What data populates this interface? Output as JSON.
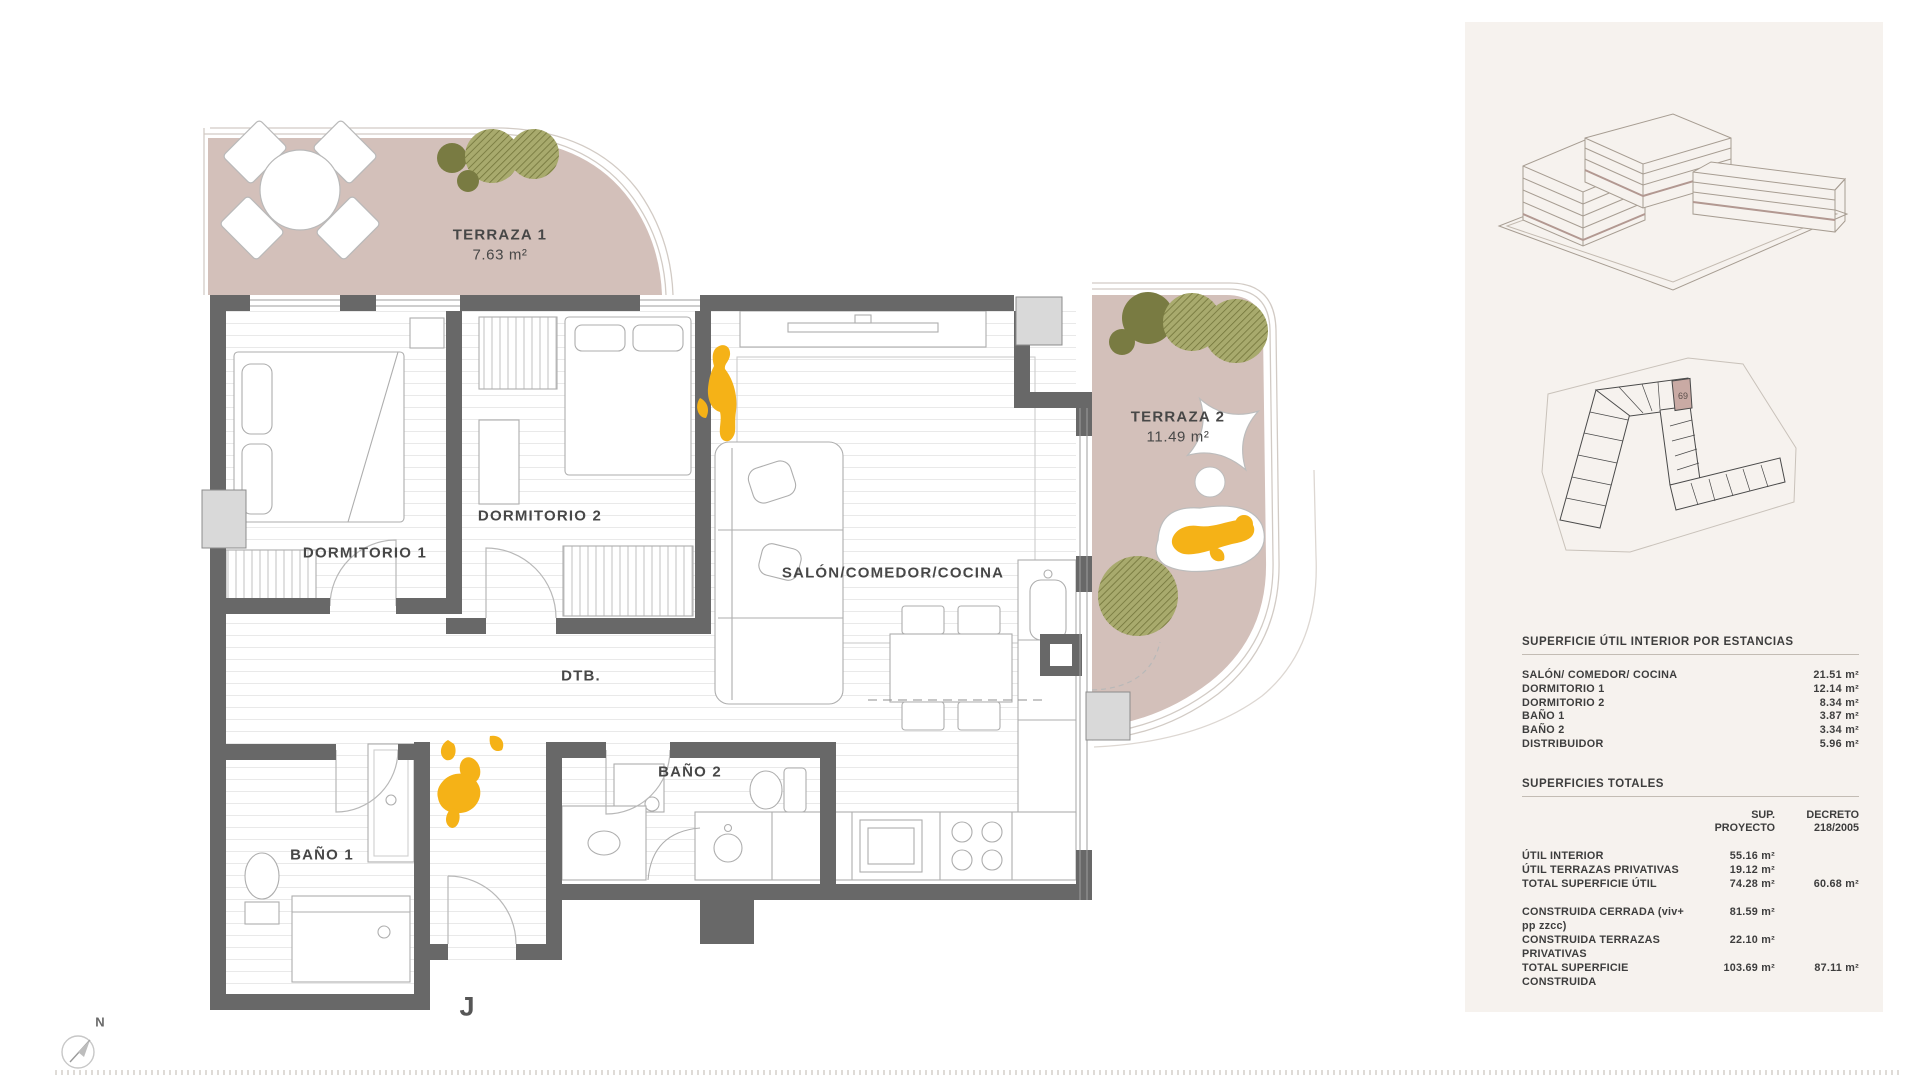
{
  "plan": {
    "terraza1": {
      "name": "TERRAZA 1",
      "area": "7.63 m²"
    },
    "terraza2": {
      "name": "TERRAZA 2",
      "area": "11.49 m²"
    },
    "rooms": {
      "dormitorio1": "DORMITORIO 1",
      "dormitorio2": "DORMITORIO 2",
      "salon": "SALÓN/COMEDOR/COCINA",
      "dtb": "DTB.",
      "bano1": "BAÑO 1",
      "bano2": "BAÑO 2"
    },
    "unit_letter": "J",
    "compass_label": "N"
  },
  "sidebar": {
    "site_plan_unit": "69",
    "interior_table": {
      "title": "SUPERFICIE ÚTIL INTERIOR POR ESTANCIAS",
      "rows": [
        {
          "label": "SALÓN/ COMEDOR/ COCINA",
          "value": "21.51 m²"
        },
        {
          "label": "DORMITORIO 1",
          "value": "12.14 m²"
        },
        {
          "label": "DORMITORIO 2",
          "value": "8.34 m²"
        },
        {
          "label": "BAÑO 1",
          "value": "3.87 m²"
        },
        {
          "label": "BAÑO 2",
          "value": "3.34 m²"
        },
        {
          "label": "DISTRIBUIDOR",
          "value": "5.96 m²"
        }
      ]
    },
    "totals_table": {
      "title": "SUPERFICIES TOTALES",
      "columns": [
        {
          "l1": "SUP.",
          "l2": "PROYECTO"
        },
        {
          "l1": "DECRETO",
          "l2": "218/2005"
        }
      ],
      "rows": [
        {
          "label": "ÚTIL INTERIOR",
          "proyecto": "55.16 m²",
          "decreto": ""
        },
        {
          "label": "ÚTIL TERRAZAS PRIVATIVAS",
          "proyecto": "19.12 m²",
          "decreto": ""
        },
        {
          "label": "TOTAL SUPERFICIE ÚTIL",
          "proyecto": "74.28 m²",
          "decreto": "60.68 m²"
        },
        {
          "label": "CONSTRUIDA CERRADA (viv+ pp zzcc)",
          "proyecto": "81.59 m²",
          "decreto": ""
        },
        {
          "label": "CONSTRUIDA TERRAZAS PRIVATIVAS",
          "proyecto": "22.10 m²",
          "decreto": ""
        },
        {
          "label": "TOTAL SUPERFICIE CONSTRUIDA",
          "proyecto": "103.69 m²",
          "decreto": "87.11 m²"
        }
      ]
    }
  },
  "colors": {
    "terrace": "#d3c0ba",
    "wall": "#686868",
    "pillar": "#d9d9d9",
    "tree_solid": "#797b42",
    "tree_hatch": "#a8aa6d",
    "person": "#f5b217",
    "sidebar_bg": "#f6f2ee",
    "highlight_cell": "#c9aaa4"
  }
}
